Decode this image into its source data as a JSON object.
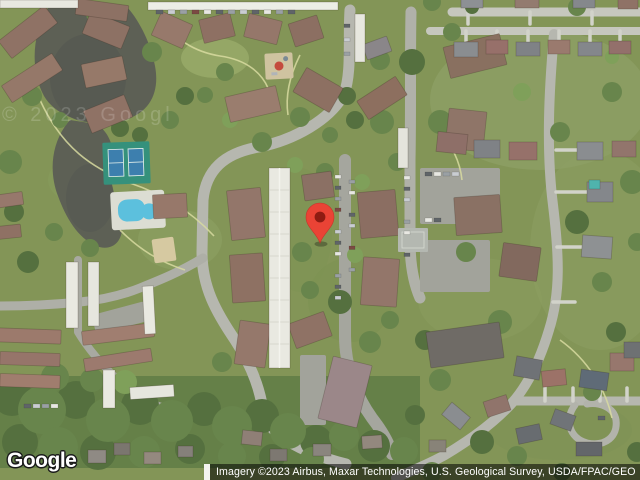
{
  "map": {
    "watermark_text": "© 2023 Googl",
    "marker": {
      "color": "#EA4335",
      "dot_color": "#8E1B12"
    }
  },
  "footer": {
    "logo_text": "Google",
    "attribution_text": "Imagery ©2023 Airbus, Maxar Technologies, U.S. Geological Survey, USDA/FPAC/GEO"
  },
  "colors": {
    "attribution_bg": "rgba(0,0,0,0.55)",
    "attribution_fg": "#ffffff",
    "marker_red": "#EA4335"
  }
}
